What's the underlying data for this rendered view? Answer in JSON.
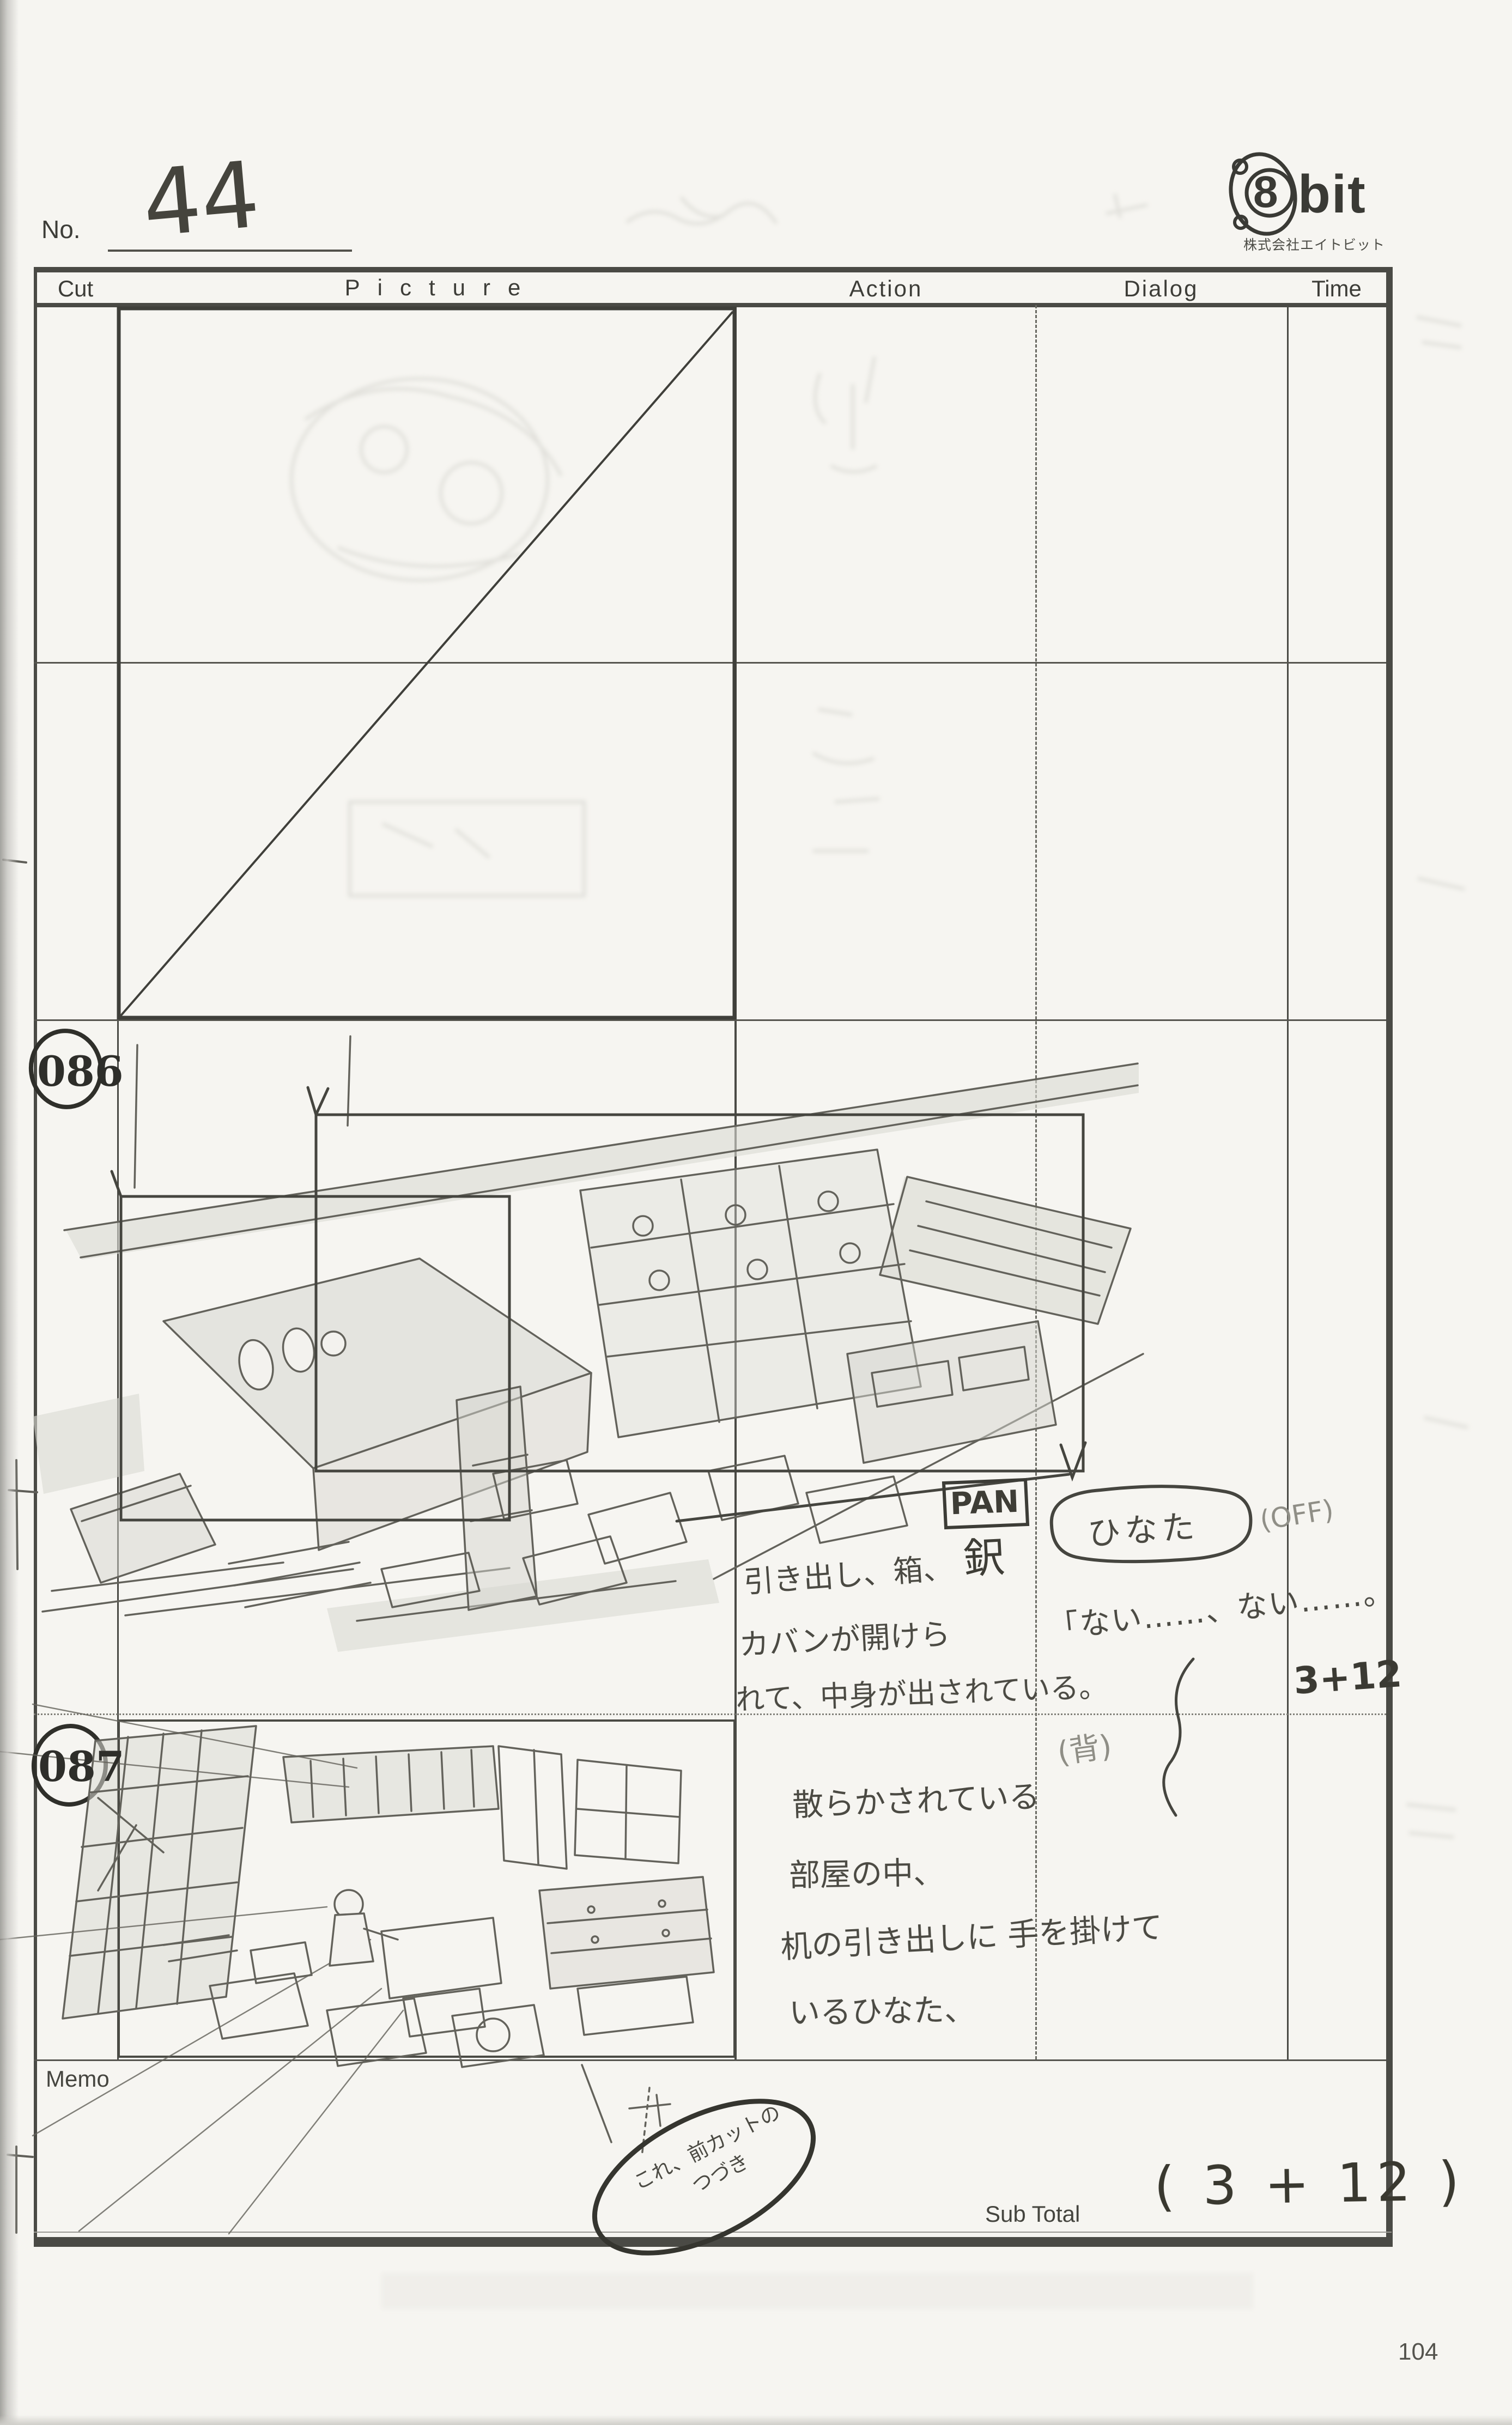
{
  "page": {
    "no_label": "No.",
    "cut_number": "44",
    "page_number": "104"
  },
  "logo": {
    "symbol": "8",
    "brand": "bit",
    "company": "株式会社エイトビット"
  },
  "headers": {
    "cut": "Cut",
    "picture": "Picture",
    "action": "Action",
    "dialog": "Dialog",
    "time": "Time"
  },
  "footer": {
    "memo_label": "Memo",
    "subtotal_label": "Sub Total",
    "subtotal_value": "( 3 + 12 )",
    "memo_note": "これ、前カットの つづき"
  },
  "cuts": [
    {
      "number": "086",
      "action_lines": [
        "引き出し、箱、",
        "カバンが開けら",
        "れて、中身が出されている。"
      ],
      "camera_label": "PAN",
      "camera_kanji": "鈬",
      "character": "ひなた",
      "modifier": "(OFF)",
      "dialog": "「ない……、ない……。",
      "dialog_note": "(背)",
      "time": "3+12"
    },
    {
      "number": "087",
      "action_lines": [
        "散らかされている",
        "部屋の中、",
        "机の引き出しに 手を掛けて",
        "いるひなた、"
      ]
    }
  ]
}
